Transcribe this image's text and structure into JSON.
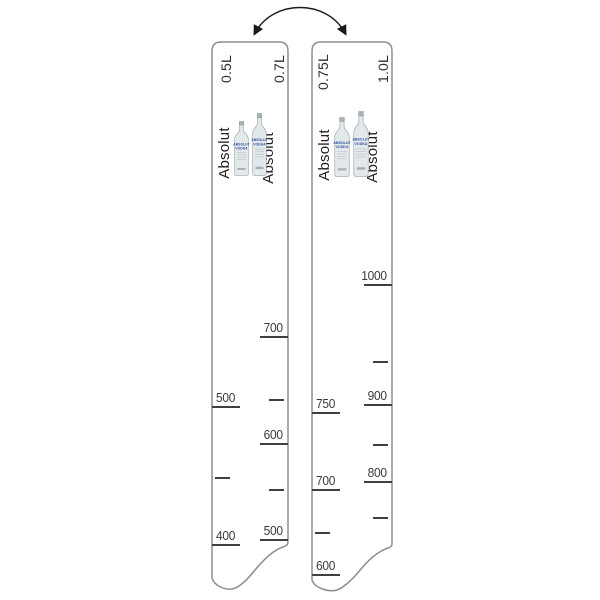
{
  "product": {
    "name": "bar-measuring-strips",
    "icons": {
      "swap_arrow": "curved-double-headed-arrow",
      "bottle": "absolut-vodka-bottle"
    },
    "colors": {
      "strip_outline": "#8e8e8e",
      "tick": "#3f3f3f",
      "text": "#3a3a3a",
      "bottle_blue": "#2e55a3",
      "bottle_glass": "#e3e8eb"
    },
    "bottle_label": {
      "line1": "ABSOLUT",
      "line2": "VODKA"
    },
    "strips": [
      {
        "name": "ruler 0.5L / 0.7L",
        "brand_left": "Absolut",
        "brand_right": "Absolut",
        "left_scale": {
          "label": "0.5L",
          "marks": [
            {
              "value": "500",
              "y": 407
            },
            {
              "value": "",
              "y": 478
            },
            {
              "value": "400",
              "y": 545
            }
          ]
        },
        "right_scale": {
          "label": "0.7L",
          "marks": [
            {
              "value": "700",
              "y": 337
            },
            {
              "value": "",
              "y": 400
            },
            {
              "value": "600",
              "y": 444
            },
            {
              "value": "",
              "y": 490
            },
            {
              "value": "500",
              "y": 540
            }
          ]
        }
      },
      {
        "name": "ruler 0.75L / 1.0L",
        "brand_left": "Absolut",
        "brand_right": "Absolut",
        "left_scale": {
          "label": "0.75L",
          "marks": [
            {
              "value": "750",
              "y": 413
            },
            {
              "value": "700",
              "y": 490
            },
            {
              "value": "",
              "y": 533
            },
            {
              "value": "600",
              "y": 575
            }
          ]
        },
        "right_scale": {
          "label": "1.0L",
          "marks": [
            {
              "value": "1000",
              "y": 285
            },
            {
              "value": "",
              "y": 362
            },
            {
              "value": "900",
              "y": 405
            },
            {
              "value": "",
              "y": 445
            },
            {
              "value": "800",
              "y": 482
            },
            {
              "value": "",
              "y": 518
            }
          ]
        }
      }
    ]
  }
}
